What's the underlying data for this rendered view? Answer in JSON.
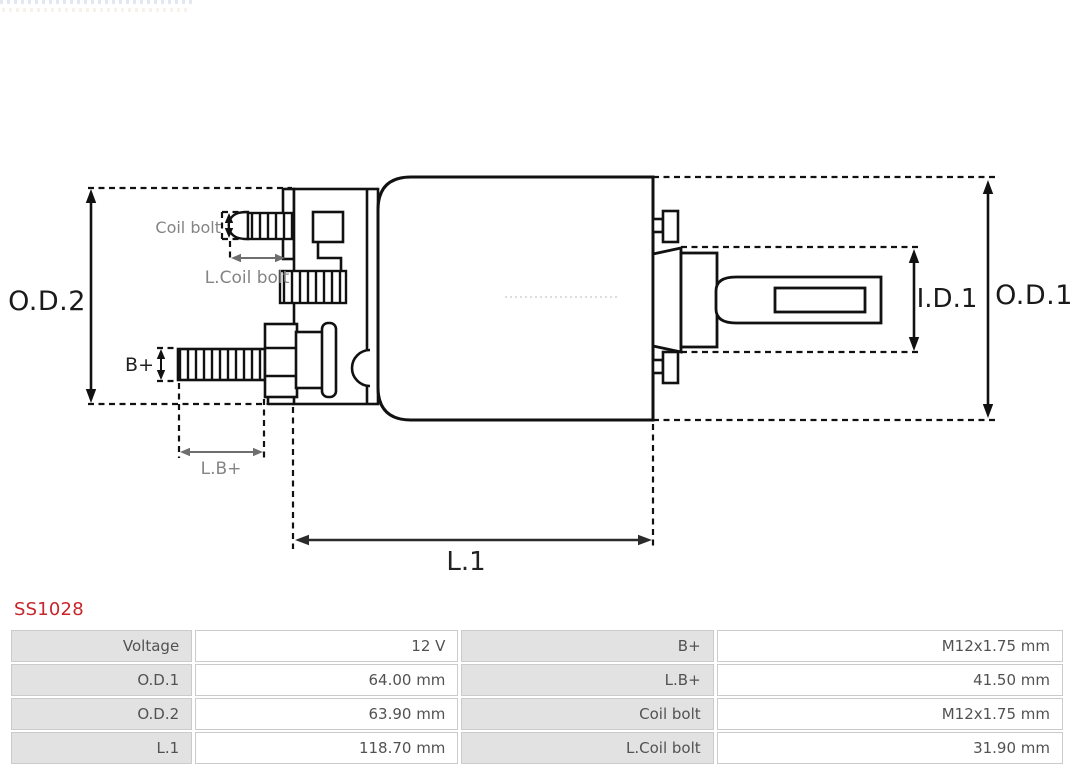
{
  "product": {
    "code": "SS1028",
    "code_color": "#C8252B"
  },
  "diagram": {
    "labels": {
      "od2": "O.D.2",
      "coil_bolt": "Coil bolt",
      "l_coil_bolt": "L.Coil bolt",
      "b_plus": "B+",
      "l_b_plus": "L.B+",
      "l1": "L.1",
      "id1": "I.D.1",
      "od1": "O.D.1"
    }
  },
  "spec_table": {
    "rows": [
      {
        "c0": "Voltage",
        "c1": "12 V",
        "c2": "B+",
        "c3": "M12x1.75 mm"
      },
      {
        "c0": "O.D.1",
        "c1": "64.00 mm",
        "c2": "L.B+",
        "c3": "41.50 mm"
      },
      {
        "c0": "O.D.2",
        "c1": "63.90 mm",
        "c2": "Coil bolt",
        "c3": "M12x1.75 mm"
      },
      {
        "c0": "L.1",
        "c1": "118.70 mm",
        "c2": "L.Coil bolt",
        "c3": "31.90 mm"
      }
    ]
  }
}
